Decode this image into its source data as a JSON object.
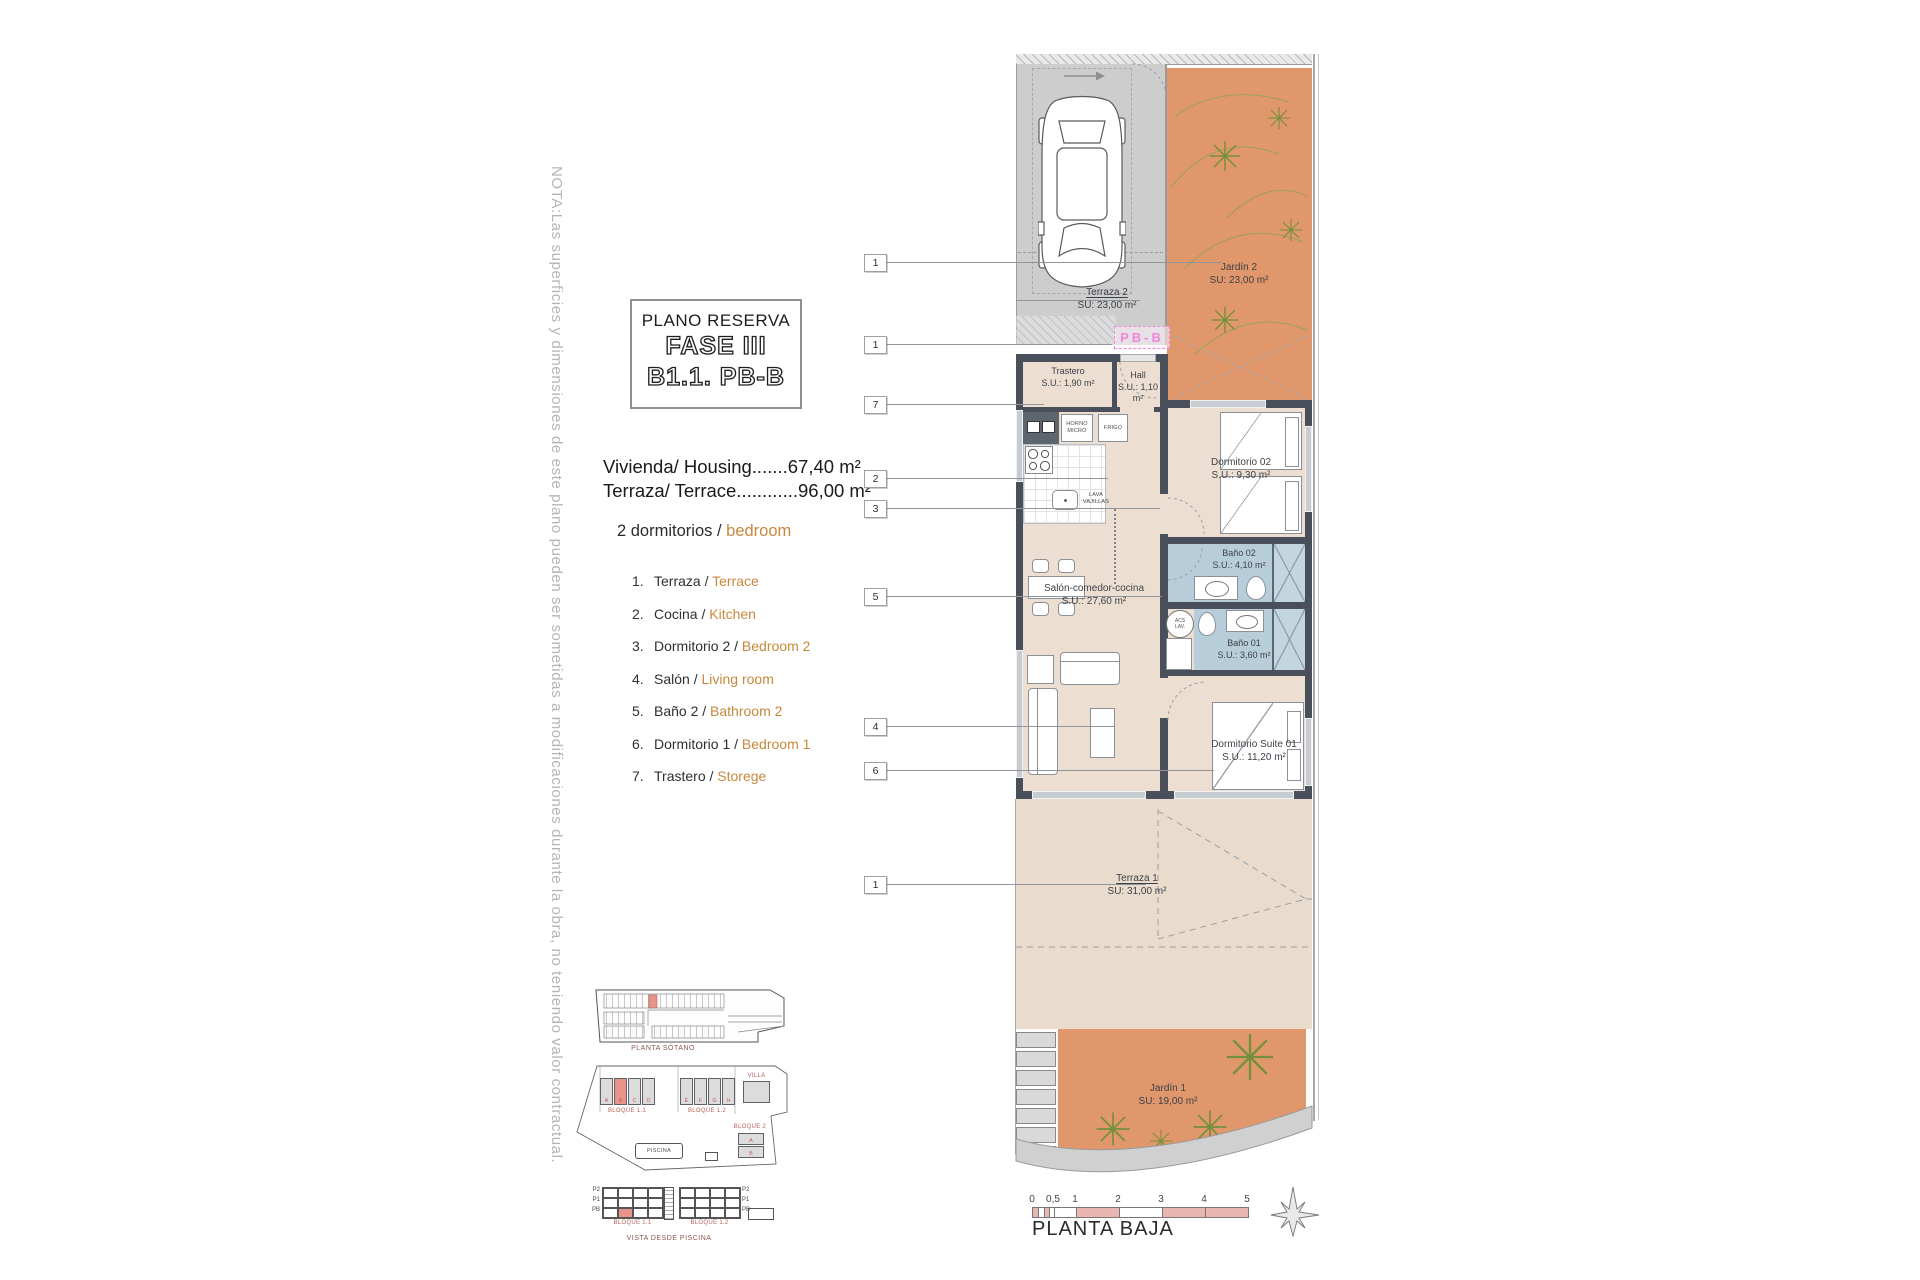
{
  "note": "NOTA:Las superficies y dimensiones de este plano pueden ser sometidas a modificaciones durante la obra, no teniendo valor contractual.",
  "title_block": {
    "subtitle": "PLANO RESERVA",
    "phase": "FASE III",
    "unit": "B1.1. PB-B"
  },
  "summary": {
    "housing": "Vivienda/ Housing.......67,40 m²",
    "terrace": "Terraza/ Terrace............96,00 m²",
    "bedrooms_es": "2 dormitorios /",
    "bedrooms_en": "bedroom"
  },
  "legend": [
    {
      "num": "1.",
      "es": "Terraza /",
      "en": "Terrace"
    },
    {
      "num": "2.",
      "es": "Cocina /",
      "en": "Kitchen"
    },
    {
      "num": "3.",
      "es": "Dormitorio 2 /",
      "en": "Bedroom 2"
    },
    {
      "num": "4.",
      "es": "Salón /",
      "en": "Living room"
    },
    {
      "num": "5.",
      "es": "Baño 2 /",
      "en": "Bathroom 2"
    },
    {
      "num": "6.",
      "es": "Dormitorio 1 /",
      "en": "Bedroom 1"
    },
    {
      "num": "7.",
      "es": "Trastero /",
      "en": "Storege"
    }
  ],
  "callouts": [
    "1",
    "1",
    "7",
    "2",
    "3",
    "5",
    "4",
    "6",
    "1"
  ],
  "plan": {
    "unit_tag": "PB-B",
    "rooms": {
      "terraza2": {
        "name": "Terraza 2",
        "area": "SU: 23,00 m²"
      },
      "jardin2": {
        "name": "Jardín 2",
        "area": "SU: 23,00 m²"
      },
      "trastero": {
        "name": "Trastero",
        "area": "S.U.: 1,90 m²"
      },
      "hall": {
        "name": "Hall",
        "area": "S.U.: 1,10 m²"
      },
      "dormitorio02": {
        "name": "Dormitorio 02",
        "area": "S.U.: 9,30 m²"
      },
      "bano02": {
        "name": "Baño 02",
        "area": "S.U.: 4,10 m²"
      },
      "bano01": {
        "name": "Baño 01",
        "area": "S.U.: 3,60 m²"
      },
      "salon": {
        "name": "Salón-comedor-cocina",
        "area": "S.U.: 27,60 m²"
      },
      "suite": {
        "name": "Dormitorio Suite 01",
        "area": "S.U.: 11,20 m²"
      },
      "terraza1": {
        "name": "Terraza 1",
        "area": "SU: 31,00 m²"
      },
      "jardin1": {
        "name": "Jardín 1",
        "area": "SU: 19,00 m²"
      }
    },
    "appliances": {
      "horno": "HORNO MICRO",
      "frigo": "FRIGO",
      "lava": "LAVA VAJILLAS",
      "acs": "ACS LAV."
    }
  },
  "site_plans": {
    "sotano_caption": "PLANTA SÓTANO",
    "bloque11": "BLOQUE 1.1",
    "bloque12": "BLOQUE 1.2",
    "bloque2": "BLOQUE 2",
    "villa": "VILLA",
    "piscina": "PISCINA",
    "vista_caption": "VISTA DESDE PISCINA",
    "units_row1": [
      "A",
      "B",
      "C",
      "D"
    ],
    "units_row2": [
      "E",
      "F",
      "G",
      "H"
    ],
    "bloque2_units": [
      "A",
      "B"
    ],
    "floors": [
      "P2",
      "P1",
      "PB"
    ]
  },
  "scale_bar": {
    "ticks": [
      "0",
      "0,5",
      "1",
      "2",
      "3",
      "4",
      "5"
    ],
    "caption": "PLANTA BAJA"
  },
  "colors": {
    "garden": "#e0976c",
    "interior": "#ecdfd2",
    "terrace": "#e9dccc",
    "parking": "#cdcdcd",
    "bath": "#b7cdd9",
    "wall": "#49505b",
    "accent_text": "#c8883c",
    "pink_tag": "#ef86d8",
    "highlight_red": "#e8948a"
  }
}
